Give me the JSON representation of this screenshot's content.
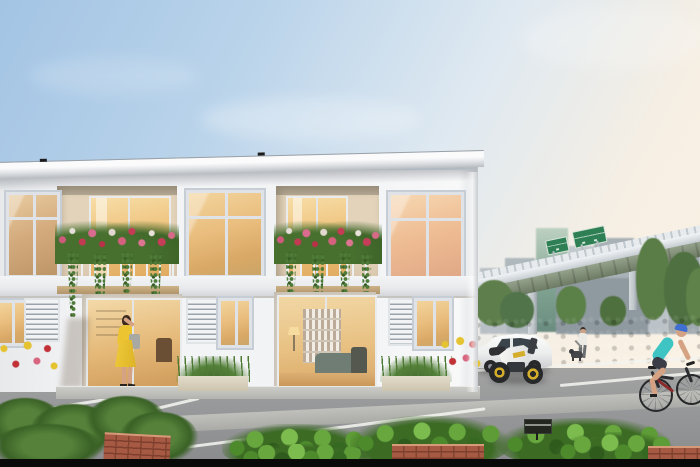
{
  "meta": {
    "description": "Dusk architectural rendering of a modern two-storey white townhouse row with lit interiors, flower-draped balconies, a front parking court, a woman in a yellow dress at the entrance, a parked white hatchback and white sport motorcycle with yellow rims, a man walking a dog, a female cyclist, a tall green hedge, city high-rises and an elevated expressway with green overhead traffic signs in the background.",
    "image_type": "photorealistic exterior render",
    "time_of_day": "dusk / early evening"
  },
  "palette": {
    "sky-top": "#a3c4e4",
    "sky-horizon": "#f7efe3",
    "wall-white": "#f2f3f5",
    "roof-fascia": "#b9bdc2",
    "window-frame": "#dfe3e8",
    "glass-warm": "#edbf78",
    "glass-warm-deep": "#dfa95e",
    "highway-deck": "#c6ccd1",
    "highway-girder": "#6d7a64",
    "sign-green": "#2e8054",
    "hedge-green": "#35502b",
    "foliage-bright": "#67a73e",
    "asphalt-grey": "#999a9b",
    "parking-line": "#f2f2ee",
    "brick-red": "#a65a43",
    "car-white": "#f2f3f2",
    "moto-rim-yellow": "#d4ad2a",
    "dress-yellow": "#ecc432",
    "bag-grey": "#a8a9a3",
    "cyclist-top-teal": "#3fc4c4",
    "helmet-blue": "#3f6fd0",
    "skin": "#d5a384",
    "black-bar": "#0a0a0a"
  },
  "scene": {
    "building": {
      "type": "two-storey modern townhouse row",
      "visible_units": 3,
      "features": [
        "flat white roof with slim fascia",
        "recessed balconies with pink/red flower boxes and trailing vines",
        "large warm-lit windows",
        "ground-floor glass sliding doors",
        "white louver panels",
        "timber-trimmed floor slab",
        "planter boxes with grasses and flowering shrubs"
      ]
    },
    "people": [
      {
        "id": "woman-yellow-dress",
        "pose": "standing at unit entrance, hand raised to brow",
        "clothing": "yellow dress",
        "accessory": "grey tote bag"
      },
      {
        "id": "man-walking-dog",
        "clothing": "white shirt, grey trousers",
        "pet": "small dark dog"
      },
      {
        "id": "female-cyclist",
        "clothing": "teal tank top, dark shorts, blue helmet",
        "action": "riding right-to-left along the hedge"
      }
    ],
    "vehicles": [
      {
        "id": "white-hatchback",
        "state": "parked, facing left"
      },
      {
        "id": "white-sport-motorcycle",
        "detail": "yellow wheel rims",
        "state": "parked in front of car"
      }
    ],
    "background": [
      "elevated expressway viaduct on Y-shaped piers",
      "two green overhead traffic signs (text not legible)",
      "city high-rise skyline incl. green glass tower",
      "street trees",
      "tall clipped hedge"
    ],
    "foreground": [
      "grey parking court with white bay markings",
      "light concrete walkway strip",
      "red brick planter walls",
      "ferns and bright leafy shrubs",
      "small dark garden plaque (text not legible)",
      "black letterbox bar at bottom edge"
    ]
  }
}
